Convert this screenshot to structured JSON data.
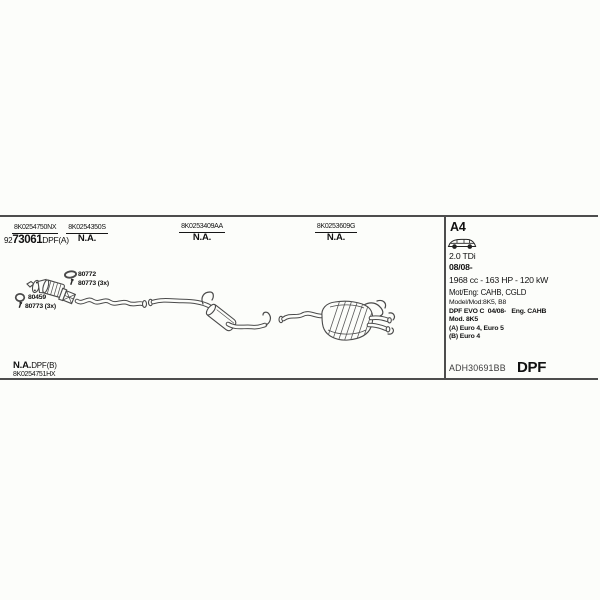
{
  "diagram": {
    "top_parts": [
      {
        "number": "8K0254750NX",
        "value_prefix": "92",
        "value": "73061",
        "value_suffix": "DPF(A)"
      },
      {
        "number": "8K0254350S",
        "value": "N.A."
      },
      {
        "number": "8K0253409AA",
        "value": "N.A."
      },
      {
        "number": "8K0253609G",
        "value": "N.A."
      }
    ],
    "hardware": [
      {
        "icon": "gasket-icon",
        "label": "80772"
      },
      {
        "icon": "bolt-icon",
        "label": "80773 (3x)"
      },
      {
        "icon": "gasket-icon",
        "label": "80459"
      },
      {
        "icon": "bolt-icon",
        "label": "80773 (3x)"
      }
    ],
    "bottom_part": {
      "value": "N.A.",
      "value_suffix": "DPF(B)",
      "number": "8K0254751HX"
    }
  },
  "info_panel": {
    "model": "A4",
    "car_icon": "wagon-icon",
    "engine": "2.0 TDi",
    "from_date": "08/08-",
    "displacement_power": "1968 cc - 163 HP - 120 kW",
    "engine_codes": "Mot/Eng: CAHB, CGLD",
    "model_codes": "Model/Mod:8K5, B8",
    "notes": [
      "DPF EVO C  04/08-   Eng. CAHB",
      "Mod. 8K5",
      "(A) Euro 4, Euro 5",
      "(B) Euro 4"
    ],
    "reference": "ADH30691BB",
    "system_type": "DPF"
  },
  "colors": {
    "background": "#fcfdfa",
    "frame_line": "#4d4d4d",
    "drawing_stroke": "#4a4a4a",
    "text": "#111111",
    "muted_text": "#3c3c3c"
  }
}
